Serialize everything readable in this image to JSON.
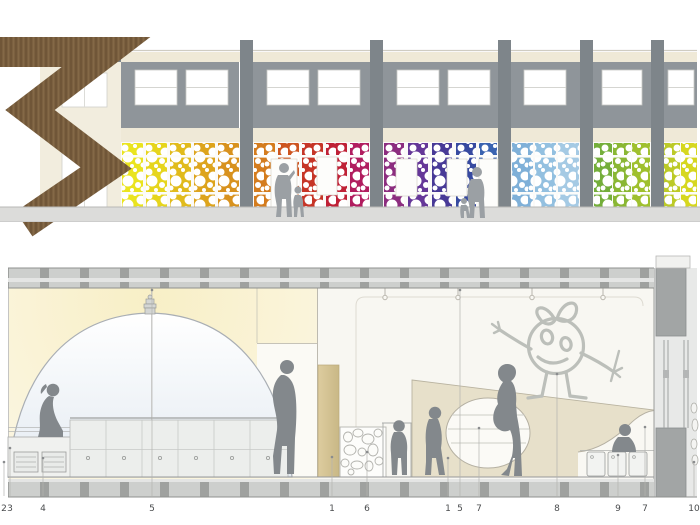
{
  "board": {
    "background": "#ffffff"
  },
  "elevation": {
    "facade_cream": "#efe9d7",
    "upper_panel_gray": "#8f959a",
    "pilaster_gray": "#7e858a",
    "wood_brown": "#7b6040",
    "wood_line": "#695033",
    "sidewalk_gray": "#dcdcda",
    "pilasters": [
      108,
      240,
      370,
      498,
      580,
      651
    ],
    "upper_windows": [
      {
        "x": 135,
        "w": 42
      },
      {
        "x": 186,
        "w": 42
      },
      {
        "x": 267,
        "w": 42
      },
      {
        "x": 318,
        "w": 42
      },
      {
        "x": 397,
        "w": 42
      },
      {
        "x": 448,
        "w": 42
      },
      {
        "x": 524,
        "w": 42
      },
      {
        "x": 602,
        "w": 40
      },
      {
        "x": 668,
        "w": 26
      }
    ],
    "panels": [
      {
        "x": 122,
        "w": 21,
        "color": "#eae41f"
      },
      {
        "x": 146,
        "w": 21,
        "color": "#e6d51d"
      },
      {
        "x": 170,
        "w": 21,
        "color": "#e1bb1c"
      },
      {
        "x": 194,
        "w": 21,
        "color": "#dda41d"
      },
      {
        "x": 218,
        "w": 21,
        "color": "#d8921e"
      },
      {
        "x": 254,
        "w": 21,
        "color": "#d47c1e"
      },
      {
        "x": 278,
        "w": 21,
        "color": "#cd5520"
      },
      {
        "x": 302,
        "w": 21,
        "color": "#c63527"
      },
      {
        "x": 326,
        "w": 21,
        "color": "#bf2136"
      },
      {
        "x": 350,
        "w": 19,
        "color": "#b11d5f"
      },
      {
        "x": 384,
        "w": 20,
        "color": "#8c2d7f"
      },
      {
        "x": 408,
        "w": 20,
        "color": "#653798"
      },
      {
        "x": 432,
        "w": 20,
        "color": "#483a97"
      },
      {
        "x": 456,
        "w": 20,
        "color": "#374aa0"
      },
      {
        "x": 479,
        "w": 18,
        "color": "#3a63b0"
      },
      {
        "x": 512,
        "w": 21,
        "color": "#7fb0d8"
      },
      {
        "x": 535,
        "w": 21,
        "color": "#93c0e0"
      },
      {
        "x": 558,
        "w": 21,
        "color": "#a5cae4"
      },
      {
        "x": 594,
        "w": 18,
        "color": "#74ae3a"
      },
      {
        "x": 613,
        "w": 18,
        "color": "#8ab734"
      },
      {
        "x": 632,
        "w": 18,
        "color": "#9fc02e"
      },
      {
        "x": 664,
        "w": 16,
        "color": "#bcca27"
      },
      {
        "x": 681,
        "w": 16,
        "color": "#d6d71f"
      }
    ],
    "openings": [
      {
        "x": 271,
        "y": 159,
        "w": 26,
        "h": 48
      },
      {
        "x": 317,
        "y": 157,
        "w": 20,
        "h": 38
      },
      {
        "x": 396,
        "y": 159,
        "w": 21,
        "h": 37
      },
      {
        "x": 447,
        "y": 159,
        "w": 20,
        "h": 37
      },
      {
        "x": 479,
        "y": 159,
        "w": 19,
        "h": 48
      }
    ]
  },
  "section": {
    "glow_yellow": "#f8f0cb",
    "dome_fill": "#e9eef3",
    "wedge_beige": "#e7e0ca",
    "tan_panel": "#d6c69b",
    "drawing_gray": "#bcbfba",
    "figure_gray": "#83888c",
    "labels": [
      {
        "n": "2",
        "x": 4,
        "ty": 462
      },
      {
        "n": "3",
        "x": 10,
        "ty": 448
      },
      {
        "n": "4",
        "x": 43,
        "ty": 458
      },
      {
        "n": "5",
        "x": 152,
        "ty": 290
      },
      {
        "n": "1",
        "x": 332,
        "ty": 457
      },
      {
        "n": "6",
        "x": 367,
        "ty": 452
      },
      {
        "n": "1",
        "x": 448,
        "ty": 458
      },
      {
        "n": "5",
        "x": 460,
        "ty": 290
      },
      {
        "n": "7",
        "x": 479,
        "ty": 428
      },
      {
        "n": "8",
        "x": 557,
        "ty": 374
      },
      {
        "n": "9",
        "x": 618,
        "ty": 455
      },
      {
        "n": "7",
        "x": 645,
        "ty": 427
      },
      {
        "n": "10",
        "x": 694,
        "ty": 462
      }
    ]
  }
}
